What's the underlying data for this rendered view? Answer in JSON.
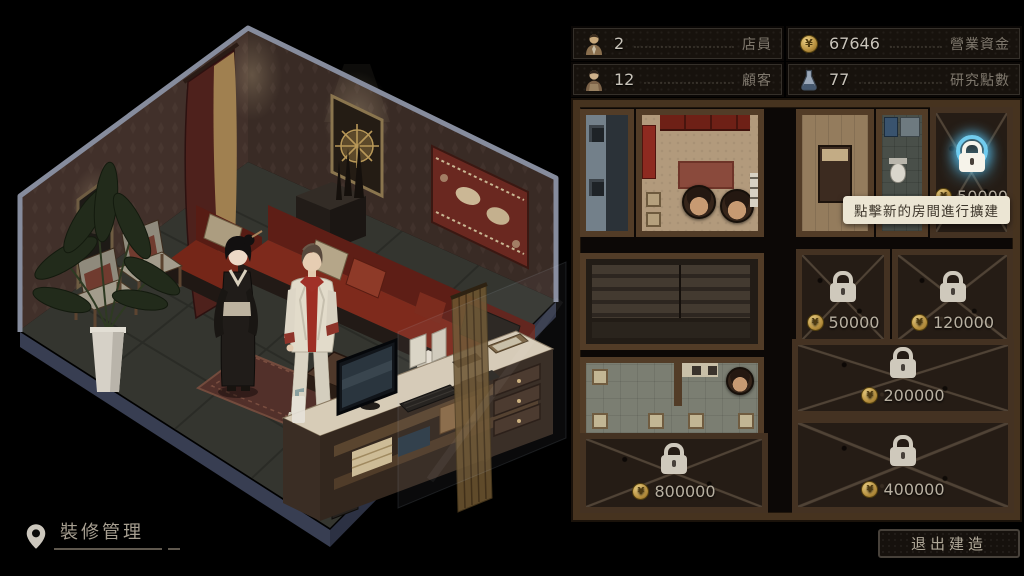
{
  "currency": {
    "symbol": "¥"
  },
  "stats": {
    "staff": {
      "value": "2",
      "label": "店員"
    },
    "funds": {
      "value": "67646",
      "label": "營業資金"
    },
    "customers": {
      "value": "12",
      "label": "顧客"
    },
    "research": {
      "value": "77",
      "label": "研究點數"
    }
  },
  "map": {
    "tooltip": "點擊新的房間進行擴建",
    "rooms": [
      {
        "id": "new-room-highlighted",
        "price": "50000",
        "state": "available"
      },
      {
        "id": "locked-room-1",
        "price": "50000",
        "state": "locked"
      },
      {
        "id": "locked-room-2",
        "price": "120000",
        "state": "locked"
      },
      {
        "id": "locked-room-3",
        "price": "200000",
        "state": "locked"
      },
      {
        "id": "locked-room-4",
        "price": "400000",
        "state": "locked"
      },
      {
        "id": "locked-room-5",
        "price": "800000",
        "state": "locked"
      }
    ]
  },
  "footer": {
    "location_label": "裝修管理"
  },
  "buttons": {
    "exit_build": "退出建造"
  },
  "colors": {
    "glow": "#5ad0f5",
    "coin_gold": "#c9a84c",
    "tooltip_bg": "#ece6d4",
    "wall_brown": "#523c27"
  }
}
